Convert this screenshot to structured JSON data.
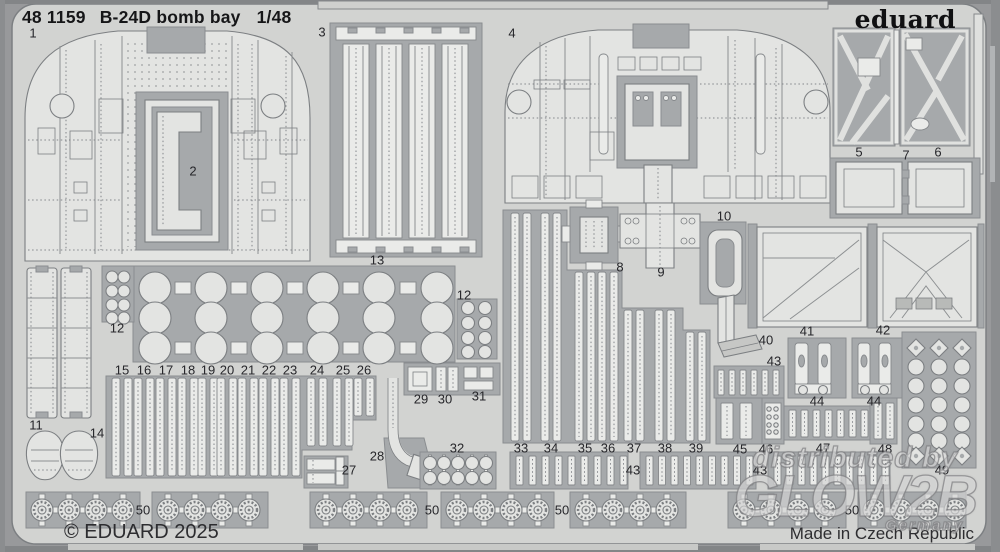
{
  "header": {
    "catalog_number": "48 1159",
    "title": "B-24D bomb bay",
    "scale": "1/48"
  },
  "brand": {
    "logo_text": "eduard"
  },
  "footer": {
    "copyright": "© EDUARD 2025",
    "origin": "Made in Czech Republic"
  },
  "watermark": {
    "line1": "distributed by",
    "line2": "GLOW2B",
    "line3": "Germany"
  },
  "colors": {
    "sheet_metal": "#d2d3d1",
    "etched_web": "#a6a9ab",
    "part_surface": "#e3e4e2",
    "outline": "#7c7f82",
    "print_text": "#1c1c1e"
  },
  "sheet": {
    "description": "photo-etched brass fret scan with numbered parts",
    "part_labels": [
      {
        "num": "1",
        "x": 33,
        "y": 34
      },
      {
        "num": "2",
        "x": 193,
        "y": 172
      },
      {
        "num": "3",
        "x": 322,
        "y": 33
      },
      {
        "num": "4",
        "x": 512,
        "y": 34
      },
      {
        "num": "5",
        "x": 859,
        "y": 153
      },
      {
        "num": "7",
        "x": 906,
        "y": 156
      },
      {
        "num": "6",
        "x": 938,
        "y": 153
      },
      {
        "num": "8",
        "x": 620,
        "y": 268
      },
      {
        "num": "9",
        "x": 661,
        "y": 273
      },
      {
        "num": "10",
        "x": 724,
        "y": 217
      },
      {
        "num": "11",
        "x": 36,
        "y": 426
      },
      {
        "num": "12",
        "x": 117,
        "y": 329
      },
      {
        "num": "13",
        "x": 377,
        "y": 261
      },
      {
        "num": "12",
        "x": 464,
        "y": 296
      },
      {
        "num": "14",
        "x": 97,
        "y": 434
      },
      {
        "num": "15",
        "x": 122,
        "y": 371
      },
      {
        "num": "16",
        "x": 144,
        "y": 371
      },
      {
        "num": "17",
        "x": 166,
        "y": 371
      },
      {
        "num": "18",
        "x": 188,
        "y": 371
      },
      {
        "num": "19",
        "x": 208,
        "y": 371
      },
      {
        "num": "20",
        "x": 227,
        "y": 371
      },
      {
        "num": "21",
        "x": 248,
        "y": 371
      },
      {
        "num": "22",
        "x": 269,
        "y": 371
      },
      {
        "num": "23",
        "x": 290,
        "y": 371
      },
      {
        "num": "24",
        "x": 317,
        "y": 371
      },
      {
        "num": "25",
        "x": 343,
        "y": 371
      },
      {
        "num": "26",
        "x": 364,
        "y": 371
      },
      {
        "num": "27",
        "x": 349,
        "y": 471
      },
      {
        "num": "28",
        "x": 377,
        "y": 457
      },
      {
        "num": "29",
        "x": 421,
        "y": 400
      },
      {
        "num": "30",
        "x": 445,
        "y": 400
      },
      {
        "num": "31",
        "x": 479,
        "y": 397
      },
      {
        "num": "32",
        "x": 457,
        "y": 449
      },
      {
        "num": "33",
        "x": 521,
        "y": 449
      },
      {
        "num": "34",
        "x": 551,
        "y": 449
      },
      {
        "num": "35",
        "x": 585,
        "y": 449
      },
      {
        "num": "36",
        "x": 608,
        "y": 449
      },
      {
        "num": "37",
        "x": 634,
        "y": 449
      },
      {
        "num": "38",
        "x": 665,
        "y": 449
      },
      {
        "num": "39",
        "x": 696,
        "y": 449
      },
      {
        "num": "40",
        "x": 766,
        "y": 341
      },
      {
        "num": "41",
        "x": 807,
        "y": 332
      },
      {
        "num": "42",
        "x": 883,
        "y": 331
      },
      {
        "num": "43",
        "x": 774,
        "y": 362
      },
      {
        "num": "43",
        "x": 633,
        "y": 471
      },
      {
        "num": "43",
        "x": 760,
        "y": 471
      },
      {
        "num": "44",
        "x": 817,
        "y": 402
      },
      {
        "num": "44",
        "x": 874,
        "y": 402
      },
      {
        "num": "45",
        "x": 740,
        "y": 450
      },
      {
        "num": "46",
        "x": 766,
        "y": 450
      },
      {
        "num": "47",
        "x": 823,
        "y": 449
      },
      {
        "num": "48",
        "x": 885,
        "y": 450
      },
      {
        "num": "49",
        "x": 942,
        "y": 471
      },
      {
        "num": "50",
        "x": 143,
        "y": 511
      },
      {
        "num": "50",
        "x": 432,
        "y": 511
      },
      {
        "num": "50",
        "x": 562,
        "y": 511
      },
      {
        "num": "50",
        "x": 852,
        "y": 511
      }
    ]
  }
}
